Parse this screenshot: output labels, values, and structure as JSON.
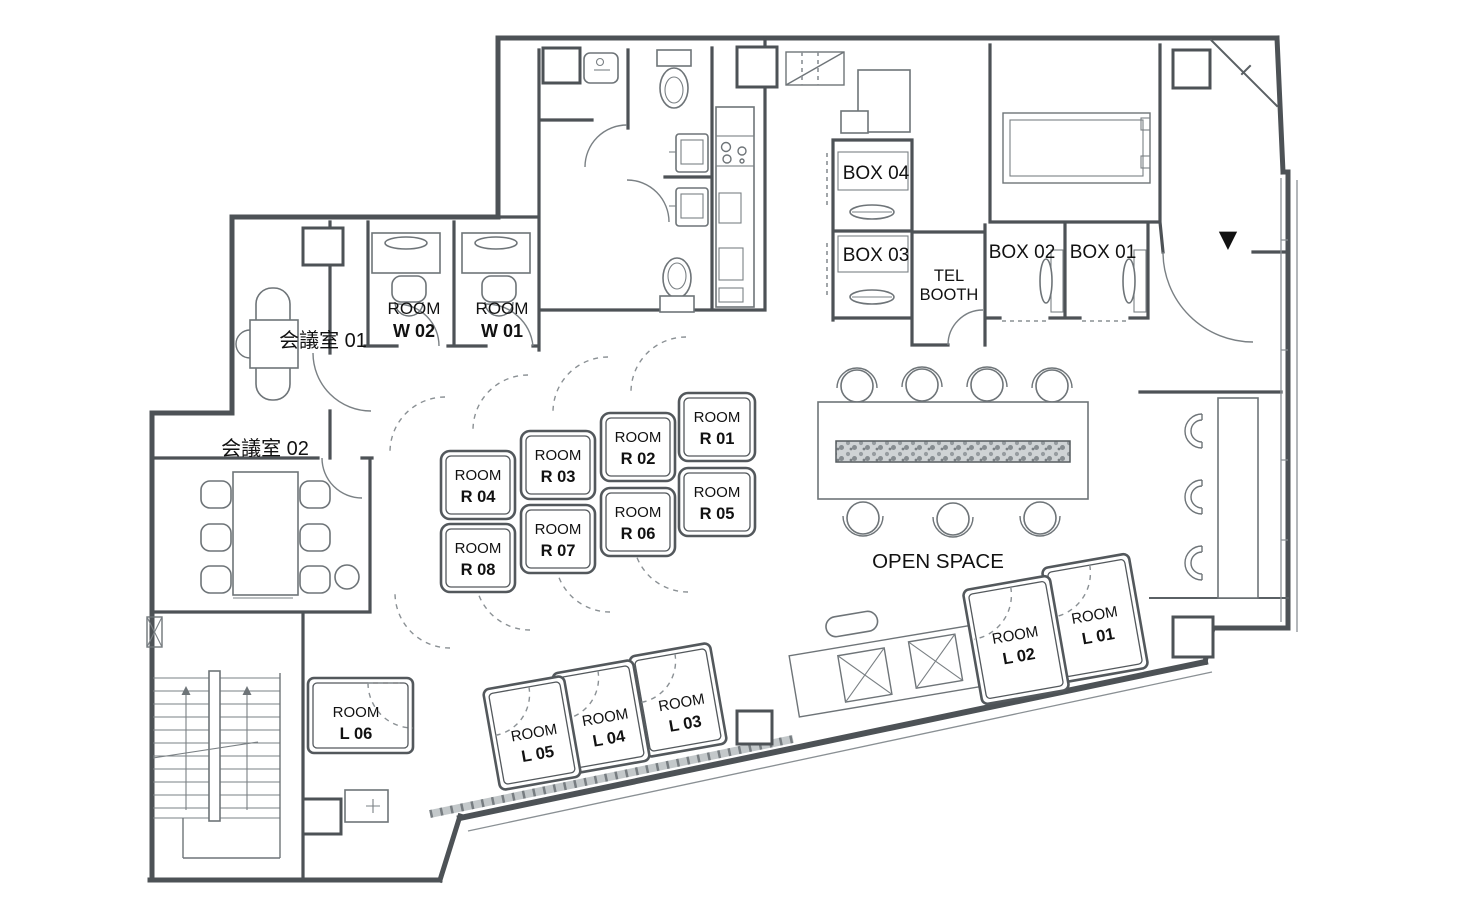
{
  "labels": {
    "meeting_room_01": "会議室 01",
    "meeting_room_02": "会議室 02",
    "open_space": "OPEN SPACE",
    "tel_booth_line1": "TEL",
    "tel_booth_line2": "BOOTH",
    "entrance_marker": "▼"
  },
  "boxes": {
    "box01": "BOX 01",
    "box02": "BOX 02",
    "box03": "BOX 03",
    "box04": "BOX 04"
  },
  "rooms": {
    "w01": {
      "type": "ROOM",
      "id": "W 01"
    },
    "w02": {
      "type": "ROOM",
      "id": "W 02"
    },
    "r01": {
      "type": "ROOM",
      "id": "R 01"
    },
    "r02": {
      "type": "ROOM",
      "id": "R 02"
    },
    "r03": {
      "type": "ROOM",
      "id": "R 03"
    },
    "r04": {
      "type": "ROOM",
      "id": "R 04"
    },
    "r05": {
      "type": "ROOM",
      "id": "R 05"
    },
    "r06": {
      "type": "ROOM",
      "id": "R 06"
    },
    "r07": {
      "type": "ROOM",
      "id": "R 07"
    },
    "r08": {
      "type": "ROOM",
      "id": "R 08"
    },
    "l01": {
      "type": "ROOM",
      "id": "L 01"
    },
    "l02": {
      "type": "ROOM",
      "id": "L 02"
    },
    "l03": {
      "type": "ROOM",
      "id": "L 03"
    },
    "l04": {
      "type": "ROOM",
      "id": "L 04"
    },
    "l05": {
      "type": "ROOM",
      "id": "L 05"
    },
    "l06": {
      "type": "ROOM",
      "id": "L 06"
    }
  },
  "colors": {
    "wall": "#4d5256",
    "furniture": "#6e7478",
    "text": "#111111",
    "background": "#ffffff"
  }
}
